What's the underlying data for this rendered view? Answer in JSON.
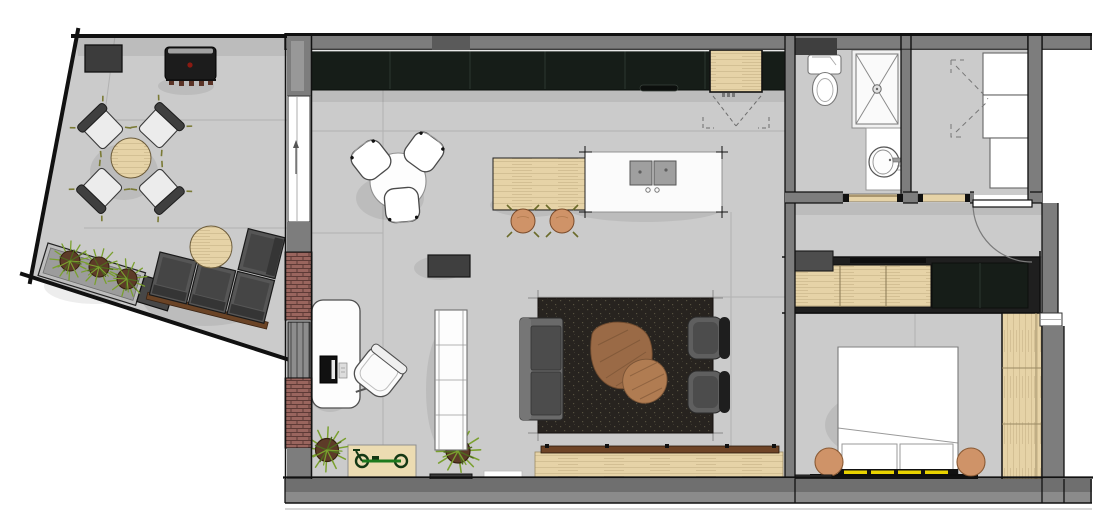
{
  "title": "apartment-floor-plan",
  "palette": {
    "floor": "#cbcbcb",
    "floor_line": "#b2b2b2",
    "wall": "#7d7d7d",
    "wall_dark": "#4f4f4f",
    "line": "#111111",
    "brick": "#9a655e",
    "brick_line": "#5e3a36",
    "cabinet": "#161d18",
    "cabinet_line": "#2c362f",
    "wood": "#e6d3a7",
    "wood_line": "#cdb98d",
    "white": "#ffffff",
    "rug": "#27231f",
    "rug_dot": "#55503f",
    "sofa": "#5f5f5f",
    "sofa_dark": "#4c4c4c",
    "seat_dark": "#1e1e1e",
    "table_brown": "#9a6a46",
    "table_brown_light": "#b07c52",
    "tan": "#cf9368",
    "plant": "#7aa02f",
    "plant_dark": "#4e6b1d",
    "pot": "#5d3b28",
    "yellow": "#e8d200",
    "bike": "#1e7a1e",
    "accent_red": "#8a1a12"
  },
  "rooms": [
    {
      "name": "terrace",
      "furniture": [
        "round-dining-table",
        "four-outdoor-chairs",
        "bbq-grill",
        "wall-planter",
        "planter-box-with-plants",
        "outdoor-corner-sofa",
        "round-coffee-table"
      ]
    },
    {
      "name": "kitchen-living",
      "furniture": [
        "kitchen-cabinet-run",
        "tall-wood-cabinet",
        "island-with-double-sink",
        "wood-dining-extension",
        "two-bar-stools",
        "round-breakfast-table",
        "three-white-chairs",
        "dark-area-rug",
        "gray-sofa",
        "two-armchairs",
        "organic-coffee-tables",
        "tv-bench",
        "white-desk",
        "desk-chair",
        "monitor",
        "open-shelf-unit",
        "dark-ottoman",
        "potted-plant",
        "bike-on-mat",
        "sliding-terrace-door",
        "radiator",
        "brick-pier"
      ]
    },
    {
      "name": "bathroom",
      "furniture": [
        "toilet",
        "walk-in-shower",
        "vanity-with-round-basin",
        "sliding-door"
      ]
    },
    {
      "name": "laundry-room",
      "furniture": [
        "stacked-white-appliances",
        "white-cabinet",
        "cabinet-door-swing-marks",
        "sliding-door"
      ]
    },
    {
      "name": "hallway",
      "furniture": [
        "entry-door-with-swing-arc"
      ]
    },
    {
      "name": "bedroom",
      "furniture": [
        "wardrobe-row-wood-and-dark",
        "tall-side-wardrobe",
        "double-bed",
        "two-pillows",
        "yellow-headboard-bench",
        "two-round-nightstands"
      ]
    }
  ]
}
